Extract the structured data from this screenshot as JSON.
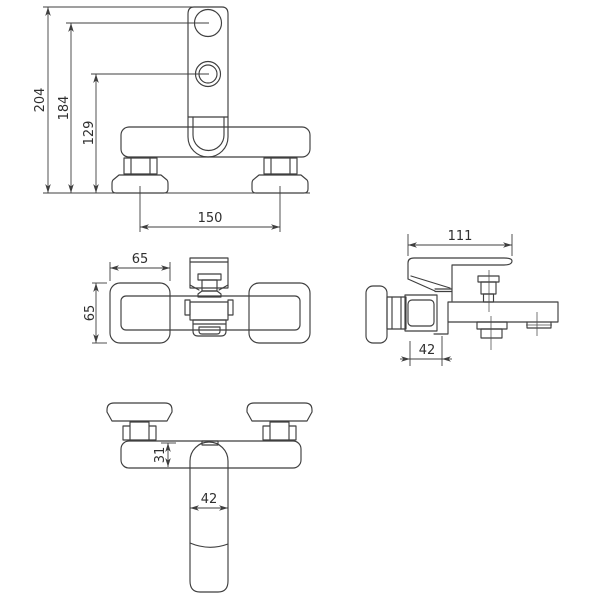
{
  "drawing": {
    "subject": "wall-mounted bath shower mixer tap - dimensional technical drawing",
    "background": "#ffffff",
    "line_color": "#3f3f3f",
    "text_color": "#2f2f2f",
    "views": {
      "front": {
        "name": "front view (riser with shower outlets)",
        "dims": {
          "total_height": "204",
          "upper_outlet_height": "184",
          "lower_outlet_height": "129",
          "mount_centers": "150"
        }
      },
      "top": {
        "name": "top view",
        "dims": {
          "handle_length": "65",
          "handle_width": "65"
        }
      },
      "side": {
        "name": "side view",
        "dims": {
          "total_depth": "111",
          "body_depth": "42"
        }
      },
      "bottom_front": {
        "name": "front view (spout down)",
        "dims": {
          "body_height": "31",
          "spout_width": "42"
        }
      }
    }
  }
}
